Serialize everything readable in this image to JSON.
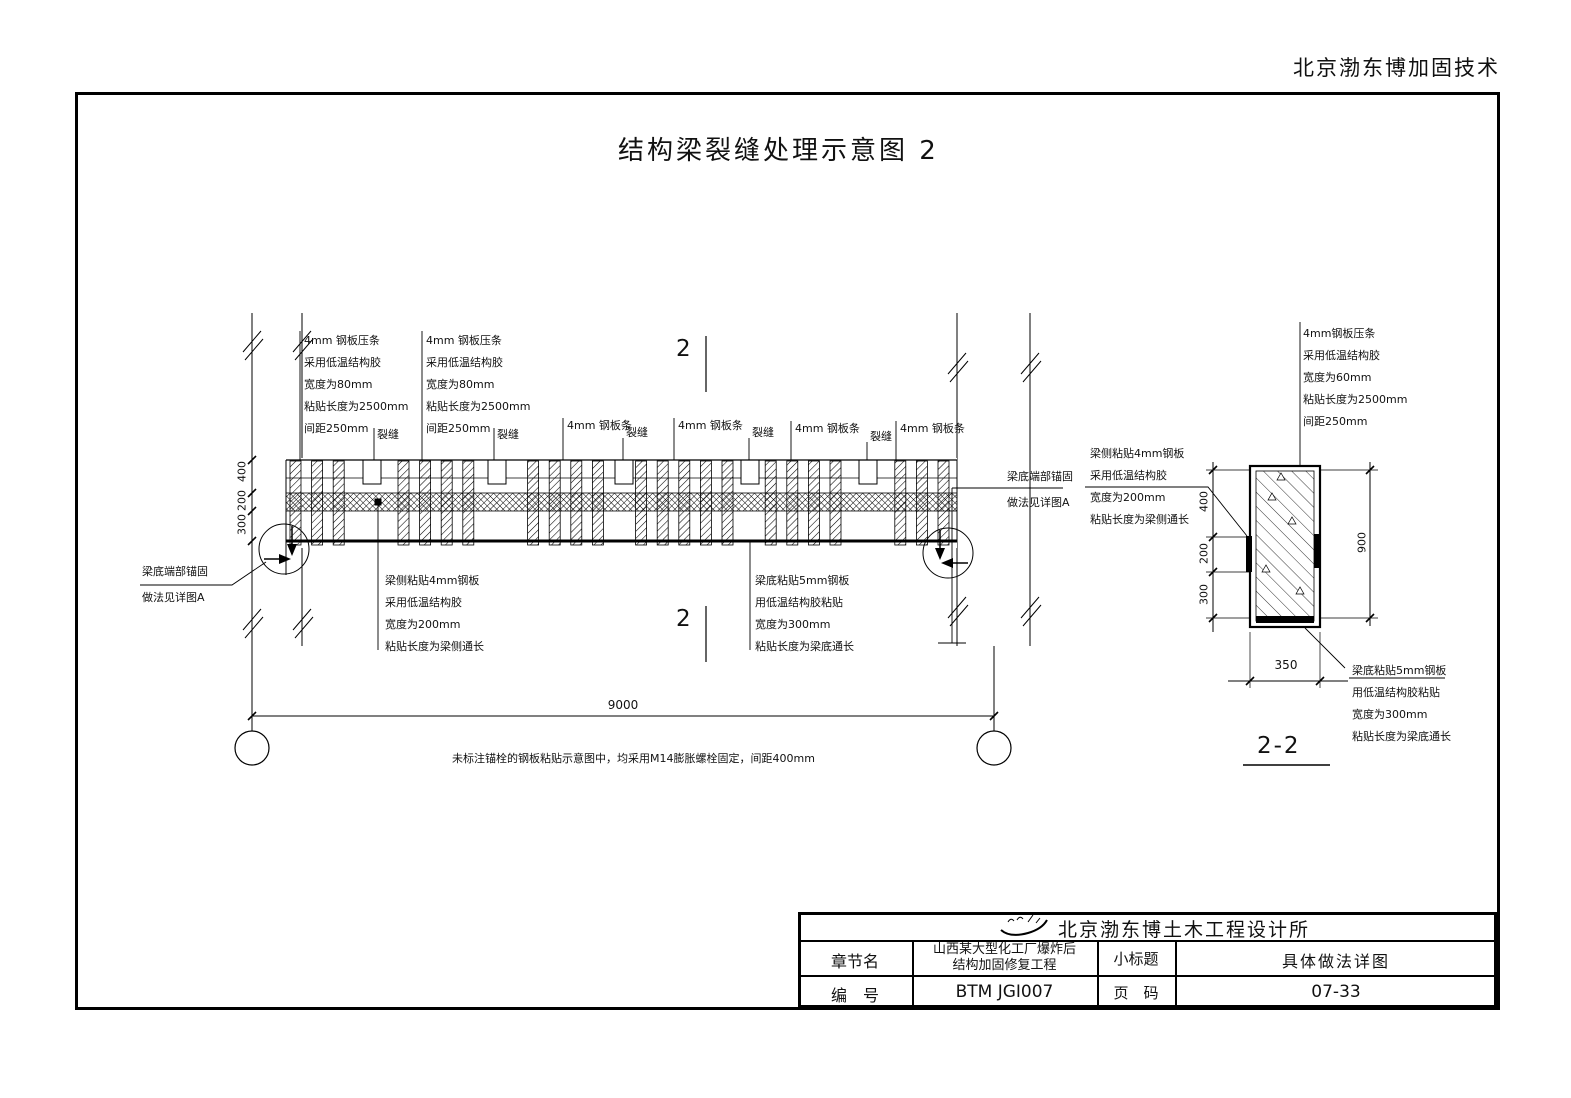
{
  "colors": {
    "ink": "#000000",
    "bg": "#ffffff"
  },
  "header": {
    "company_top_right": "北京渤东博加固技术"
  },
  "title": "结构梁裂缝处理示意图 2",
  "elevation": {
    "ann_strip_top": {
      "l1": "4mm 钢板压条",
      "l2": "采用低温结构胶",
      "l3": "宽度为80mm",
      "l4": "粘贴长度为2500mm",
      "l5": "间距250mm"
    },
    "strip_label": "4mm 钢板条",
    "crack_label": "裂缝",
    "section_mark": "2",
    "anchor_note": {
      "l1": "梁底端部锚固",
      "l2": "做法见详图A"
    },
    "ann_side_plate": {
      "l1": "梁侧粘贴4mm钢板",
      "l2": "采用低温结构胶",
      "l3": "宽度为200mm",
      "l4": "粘贴长度为梁侧通长"
    },
    "ann_bottom_plate": {
      "l1": "梁底粘贴5mm钢板",
      "l2": "用低温结构胶粘贴",
      "l3": "宽度为300mm",
      "l4": "粘贴长度为梁底通长"
    },
    "dim_400": "400",
    "dim_200": "200",
    "dim_300": "300",
    "dim_span": "9000"
  },
  "section": {
    "title": "2-2",
    "ann_strip": {
      "l1": "4mm钢板压条",
      "l2": "采用低温结构胶",
      "l3": "宽度为60mm",
      "l4": "粘贴长度为2500mm",
      "l5": "间距250mm"
    },
    "ann_side_plate": {
      "l1": "梁侧粘贴4mm钢板",
      "l2": "采用低温结构胶",
      "l3": "宽度为200mm",
      "l4": "粘贴长度为梁侧通长"
    },
    "ann_bottom_plate": {
      "l1": "梁底粘贴5mm钢板",
      "l2": "用低温结构胶粘贴",
      "l3": "宽度为300mm",
      "l4": "粘贴长度为梁底通长"
    },
    "dim_400": "400",
    "dim_200": "200",
    "dim_300": "300",
    "dim_900": "900",
    "dim_350": "350"
  },
  "note": "未标注锚栓的钢板粘贴示意图中，均采用M14膨胀螺栓固定，间距400mm",
  "titleblock": {
    "company": "北京渤东博土木工程设计所",
    "row1_label1": "章节名",
    "row1_value1a": "山西某大型化工厂爆炸后",
    "row1_value1b": "结构加固修复工程",
    "row1_label2": "小标题",
    "row1_value2": "具体做法详图",
    "row2_label1": "编　号",
    "row2_value1": "BTM JGI007",
    "row2_label2": "页　码",
    "row2_value2": "07-33"
  }
}
